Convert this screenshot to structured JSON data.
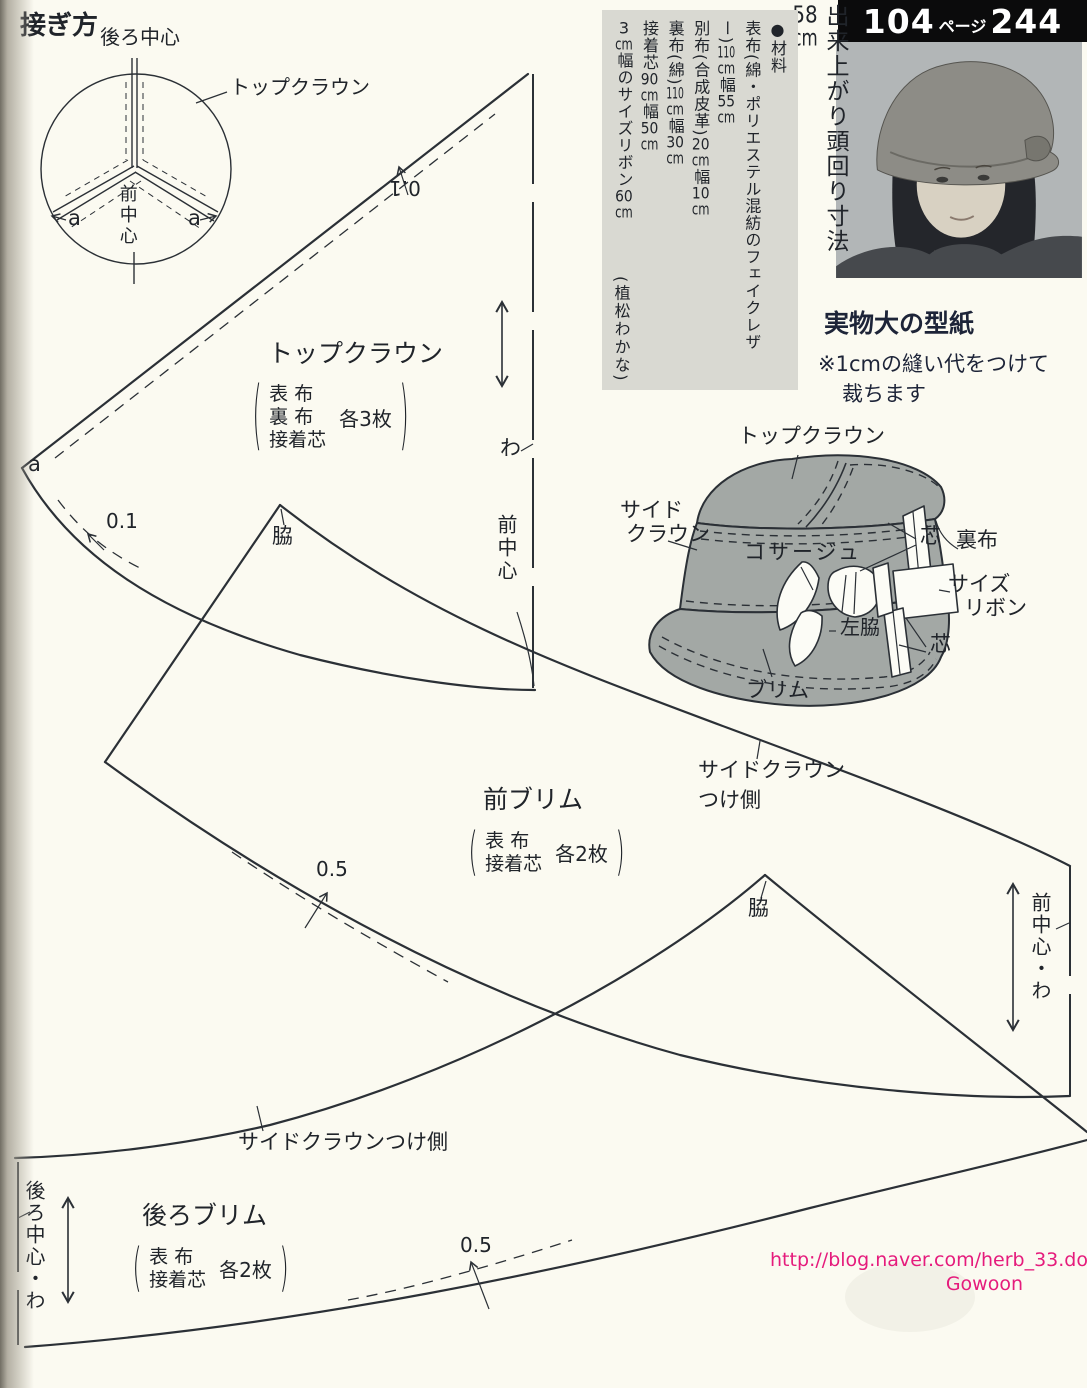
{
  "page": {
    "bg": "#fbfaf1",
    "ink": "#20242a",
    "line_color": "#2b3036",
    "hat_gray": "#a3a8a5",
    "materials_box_gray": "#d9d9d2",
    "watermark_pink": "#e51b7c",
    "photo_gray": "#b5b9ba"
  },
  "header": {
    "num_left": "104",
    "word": "ページ",
    "num_right": "244"
  },
  "finished_size": {
    "segs": [
      [
        "t",
        "出来上がり頭回り寸法"
      ],
      [
        "c",
        "58"
      ],
      [
        "c",
        "cm"
      ]
    ]
  },
  "materials": {
    "lines": [
      [
        [
          "t",
          "●材料"
        ]
      ],
      [
        [
          "t",
          "表布(綿・ポリエステル混紡のフェイクレザー)"
        ],
        [
          "c",
          "110"
        ],
        [
          "c",
          "cm"
        ],
        [
          "t",
          "幅"
        ],
        [
          "c",
          "55"
        ],
        [
          "c",
          "cm"
        ]
      ],
      [
        [
          "t",
          "別布(合成皮革)"
        ],
        [
          "c",
          "20"
        ],
        [
          "c",
          "cm"
        ],
        [
          "t",
          "幅"
        ],
        [
          "c",
          "10"
        ],
        [
          "c",
          "cm"
        ]
      ],
      [
        [
          "t",
          "裏布(綿)"
        ],
        [
          "c",
          "110"
        ],
        [
          "c",
          "cm"
        ],
        [
          "t",
          "幅"
        ],
        [
          "c",
          "30"
        ],
        [
          "c",
          "cm"
        ]
      ],
      [
        [
          "t",
          "接着芯"
        ],
        [
          "c",
          "90"
        ],
        [
          "c",
          "cm"
        ],
        [
          "t",
          "幅"
        ],
        [
          "c",
          "50"
        ],
        [
          "c",
          "cm"
        ]
      ],
      [
        [
          "c",
          "3"
        ],
        [
          "c",
          "cm"
        ],
        [
          "t",
          "幅のサイズリボン"
        ],
        [
          "c",
          "60"
        ],
        [
          "c",
          "cm"
        ]
      ]
    ],
    "credit": "(植松わかな)"
  },
  "full_size_note": {
    "title": "実物大の型紙",
    "line1": "※1cmの縫い代をつけて",
    "line2": "裁ちます"
  },
  "join_diagram": {
    "title": "接ぎ方",
    "back_center": "後ろ中心",
    "top_crown": "トップクラウン",
    "front_center": "前中心",
    "a_left": "a",
    "a_right": "a"
  },
  "top_crown": {
    "title": "トップクラウン",
    "fabrics": [
      "表 布",
      "裏 布",
      "接着芯"
    ],
    "count": "各3枚",
    "seam_top": "0.1",
    "seam_bottom": "0.1",
    "fold": "わ",
    "front_center": "前中心"
  },
  "front_brim": {
    "title": "前ブリム",
    "fabrics": [
      "表 布",
      "接着芯"
    ],
    "count": "各2枚",
    "side": "脇",
    "seam": "0.5",
    "fold_edge": "前中心・わ",
    "attach1": "サイドクラウン",
    "attach2": "つけ側"
  },
  "back_brim": {
    "title": "後ろブリム",
    "fabrics": [
      "表 布",
      "接着芯"
    ],
    "count": "各2枚",
    "side": "脇",
    "seam": "0.5",
    "fold_edge": "後ろ中心・わ",
    "attach": "サイドクラウンつけ側"
  },
  "hat": {
    "top_crown": "トップクラウン",
    "side_crown1": "サイド",
    "side_crown2": "クラウン",
    "corsage": "コサージュ",
    "core_top": "芯",
    "lining": "裏布",
    "ribbon1": "サイズ",
    "ribbon2": "リボン",
    "left_side": "左脇",
    "core_bottom": "芯",
    "brim": "ブリム"
  },
  "watermark": {
    "url": "http://blog.naver.com/herb_33.do",
    "signature": "Gowoon"
  }
}
